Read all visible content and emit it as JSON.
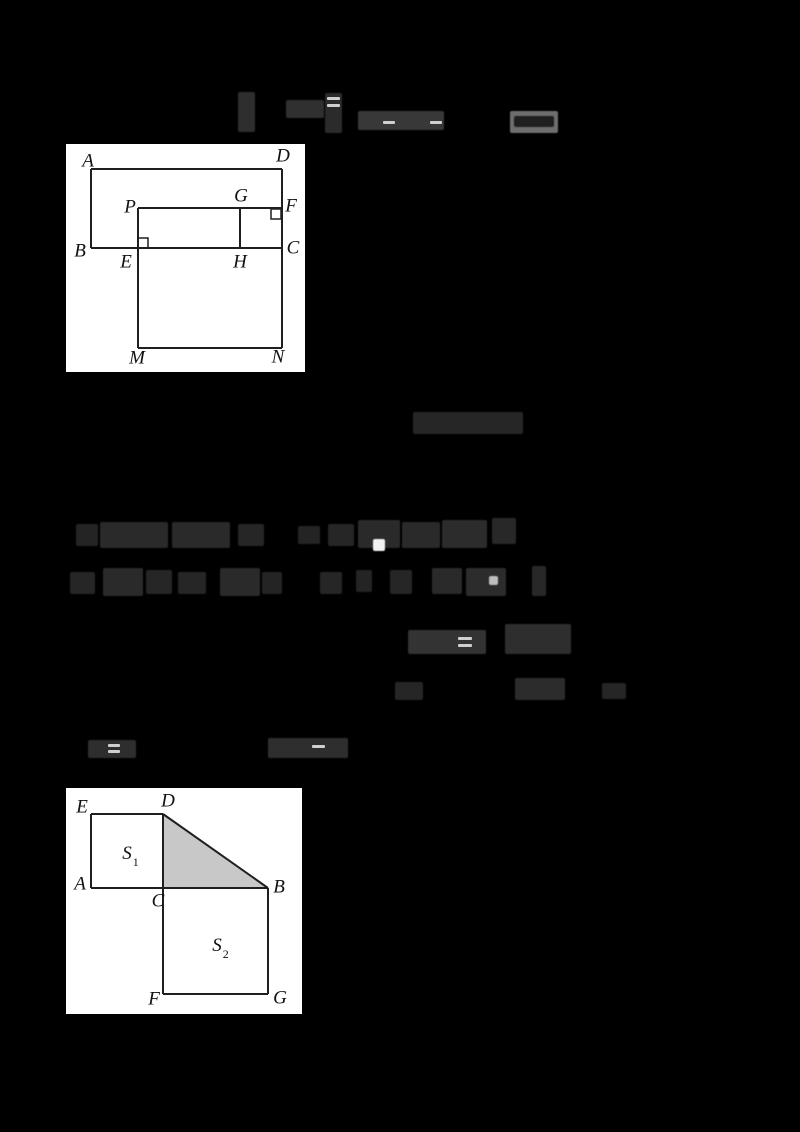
{
  "page": {
    "width": 800,
    "height": 1132,
    "background": "#000000"
  },
  "figures": [
    {
      "id": "figure1",
      "description": "rectangle-ABCD-with-inner-rectangle-PFCE-segment-GH-and-square-EMNC",
      "box": {
        "x": 66,
        "y": 144,
        "w": 239,
        "h": 228
      },
      "bg": "#ffffff",
      "stroke": "#1f1f1f",
      "stroke_width": 2,
      "lines": [
        [
          25,
          25,
          216,
          25
        ],
        [
          25,
          25,
          25,
          104
        ],
        [
          25,
          104,
          216,
          104
        ],
        [
          216,
          25,
          216,
          204
        ],
        [
          72,
          64,
          216,
          64
        ],
        [
          72,
          64,
          72,
          204
        ],
        [
          174,
          64,
          174,
          104
        ],
        [
          72,
          204,
          216,
          204
        ]
      ],
      "right_angle_marks": [
        {
          "x": 72,
          "y": 94,
          "size": 10
        },
        {
          "x": 205,
          "y": 65,
          "size": 10
        }
      ],
      "labels": [
        {
          "text": "A",
          "x": 22,
          "y": 17
        },
        {
          "text": "D",
          "x": 217,
          "y": 12
        },
        {
          "text": "P",
          "x": 64,
          "y": 63
        },
        {
          "text": "G",
          "x": 175,
          "y": 52
        },
        {
          "text": "F",
          "x": 225,
          "y": 62
        },
        {
          "text": "B",
          "x": 14,
          "y": 107
        },
        {
          "text": "E",
          "x": 60,
          "y": 118
        },
        {
          "text": "H",
          "x": 174,
          "y": 118
        },
        {
          "text": "C",
          "x": 227,
          "y": 104
        },
        {
          "text": "M",
          "x": 71,
          "y": 214
        },
        {
          "text": "N",
          "x": 212,
          "y": 213
        }
      ]
    },
    {
      "id": "figure2",
      "description": "square-S1-AEDC-shaded-triangle-DCB-square-S2-CBGF",
      "box": {
        "x": 66,
        "y": 788,
        "w": 236,
        "h": 226
      },
      "bg": "#ffffff",
      "stroke": "#1f1f1f",
      "stroke_width": 2,
      "polygons": [
        {
          "name": "shaded-triangle-DCB",
          "points": [
            [
              97,
              26
            ],
            [
              97,
              100
            ],
            [
              202,
              100
            ]
          ],
          "fill": "#c8c8c8"
        }
      ],
      "lines": [
        [
          25,
          26,
          97,
          26
        ],
        [
          25,
          26,
          25,
          100
        ],
        [
          25,
          100,
          202,
          100
        ],
        [
          97,
          26,
          97,
          206
        ],
        [
          97,
          26,
          202,
          100
        ],
        [
          202,
          100,
          202,
          206
        ],
        [
          97,
          206,
          202,
          206
        ]
      ],
      "right_angle_marks": [],
      "labels": [
        {
          "text": "E",
          "x": 16,
          "y": 19
        },
        {
          "text": "D",
          "x": 102,
          "y": 13
        },
        {
          "text": "S",
          "sub": "1",
          "x": 64,
          "y": 67
        },
        {
          "text": "A",
          "x": 14,
          "y": 96
        },
        {
          "text": "C",
          "x": 92,
          "y": 113
        },
        {
          "text": "B",
          "x": 213,
          "y": 99
        },
        {
          "text": "S",
          "sub": "2",
          "x": 154,
          "y": 159
        },
        {
          "text": "F",
          "x": 88,
          "y": 211
        },
        {
          "text": "G",
          "x": 214,
          "y": 210
        }
      ]
    }
  ],
  "illegible_text_runs": [
    {
      "x": 238,
      "y": 92,
      "w": 17,
      "h": 40,
      "c": "#2e2e2e"
    },
    {
      "x": 286,
      "y": 100,
      "w": 38,
      "h": 18,
      "c": "#303030"
    },
    {
      "x": 325,
      "y": 93,
      "w": 17,
      "h": 40,
      "c": "#2b2b2b"
    },
    {
      "x": 358,
      "y": 111,
      "w": 86,
      "h": 19,
      "c": "#383838"
    },
    {
      "x": 510,
      "y": 111,
      "w": 48,
      "h": 22,
      "c": "#6e6e6e"
    },
    {
      "x": 514,
      "y": 116,
      "w": 40,
      "h": 11,
      "c": "#1f1f1f"
    },
    {
      "x": 413,
      "y": 412,
      "w": 110,
      "h": 22,
      "c": "#262626"
    },
    {
      "x": 76,
      "y": 524,
      "w": 22,
      "h": 22,
      "c": "#242424"
    },
    {
      "x": 100,
      "y": 522,
      "w": 68,
      "h": 26,
      "c": "#2a2a2a"
    },
    {
      "x": 172,
      "y": 522,
      "w": 58,
      "h": 26,
      "c": "#2a2a2a"
    },
    {
      "x": 238,
      "y": 524,
      "w": 26,
      "h": 22,
      "c": "#262626"
    },
    {
      "x": 298,
      "y": 526,
      "w": 22,
      "h": 18,
      "c": "#242424"
    },
    {
      "x": 328,
      "y": 524,
      "w": 26,
      "h": 22,
      "c": "#262626"
    },
    {
      "x": 358,
      "y": 520,
      "w": 42,
      "h": 28,
      "c": "#2a2a2a"
    },
    {
      "x": 402,
      "y": 522,
      "w": 38,
      "h": 26,
      "c": "#2a2a2a"
    },
    {
      "x": 442,
      "y": 520,
      "w": 45,
      "h": 28,
      "c": "#2c2c2c"
    },
    {
      "x": 492,
      "y": 518,
      "w": 24,
      "h": 26,
      "c": "#282828"
    },
    {
      "x": 70,
      "y": 572,
      "w": 25,
      "h": 22,
      "c": "#262626"
    },
    {
      "x": 103,
      "y": 568,
      "w": 40,
      "h": 28,
      "c": "#2a2a2a"
    },
    {
      "x": 146,
      "y": 570,
      "w": 26,
      "h": 24,
      "c": "#262626"
    },
    {
      "x": 178,
      "y": 572,
      "w": 28,
      "h": 22,
      "c": "#262626"
    },
    {
      "x": 220,
      "y": 568,
      "w": 40,
      "h": 28,
      "c": "#2a2a2a"
    },
    {
      "x": 262,
      "y": 572,
      "w": 20,
      "h": 22,
      "c": "#242424"
    },
    {
      "x": 320,
      "y": 572,
      "w": 22,
      "h": 22,
      "c": "#262626"
    },
    {
      "x": 356,
      "y": 570,
      "w": 16,
      "h": 22,
      "c": "#242424"
    },
    {
      "x": 390,
      "y": 570,
      "w": 22,
      "h": 24,
      "c": "#262626"
    },
    {
      "x": 432,
      "y": 568,
      "w": 30,
      "h": 26,
      "c": "#2a2a2a"
    },
    {
      "x": 466,
      "y": 568,
      "w": 40,
      "h": 28,
      "c": "#2c2c2c"
    },
    {
      "x": 532,
      "y": 566,
      "w": 14,
      "h": 30,
      "c": "#282828"
    },
    {
      "x": 408,
      "y": 630,
      "w": 78,
      "h": 24,
      "c": "#333333"
    },
    {
      "x": 505,
      "y": 624,
      "w": 66,
      "h": 30,
      "c": "#2e2e2e"
    },
    {
      "x": 395,
      "y": 682,
      "w": 28,
      "h": 18,
      "c": "#262626"
    },
    {
      "x": 515,
      "y": 678,
      "w": 50,
      "h": 22,
      "c": "#2c2c2c"
    },
    {
      "x": 602,
      "y": 683,
      "w": 24,
      "h": 16,
      "c": "#262626"
    },
    {
      "x": 88,
      "y": 740,
      "w": 48,
      "h": 18,
      "c": "#2e2e2e"
    },
    {
      "x": 268,
      "y": 738,
      "w": 80,
      "h": 20,
      "c": "#2e2e2e"
    },
    {
      "x": 373,
      "y": 539,
      "w": 12,
      "h": 12,
      "c": "#f2f2f2"
    },
    {
      "x": 489,
      "y": 576,
      "w": 9,
      "h": 9,
      "c": "#bdbdbd"
    }
  ],
  "light_dashes": [
    {
      "x": 327,
      "y": 97,
      "w": 13,
      "h": 3
    },
    {
      "x": 327,
      "y": 104,
      "w": 13,
      "h": 3
    },
    {
      "x": 383,
      "y": 121,
      "w": 12,
      "h": 3
    },
    {
      "x": 430,
      "y": 121,
      "w": 12,
      "h": 3
    },
    {
      "x": 458,
      "y": 637,
      "w": 14,
      "h": 3
    },
    {
      "x": 458,
      "y": 644,
      "w": 14,
      "h": 3
    },
    {
      "x": 108,
      "y": 744,
      "w": 12,
      "h": 3
    },
    {
      "x": 108,
      "y": 750,
      "w": 12,
      "h": 3
    },
    {
      "x": 312,
      "y": 745,
      "w": 13,
      "h": 3
    }
  ],
  "dash_color": "#cfcfcf"
}
